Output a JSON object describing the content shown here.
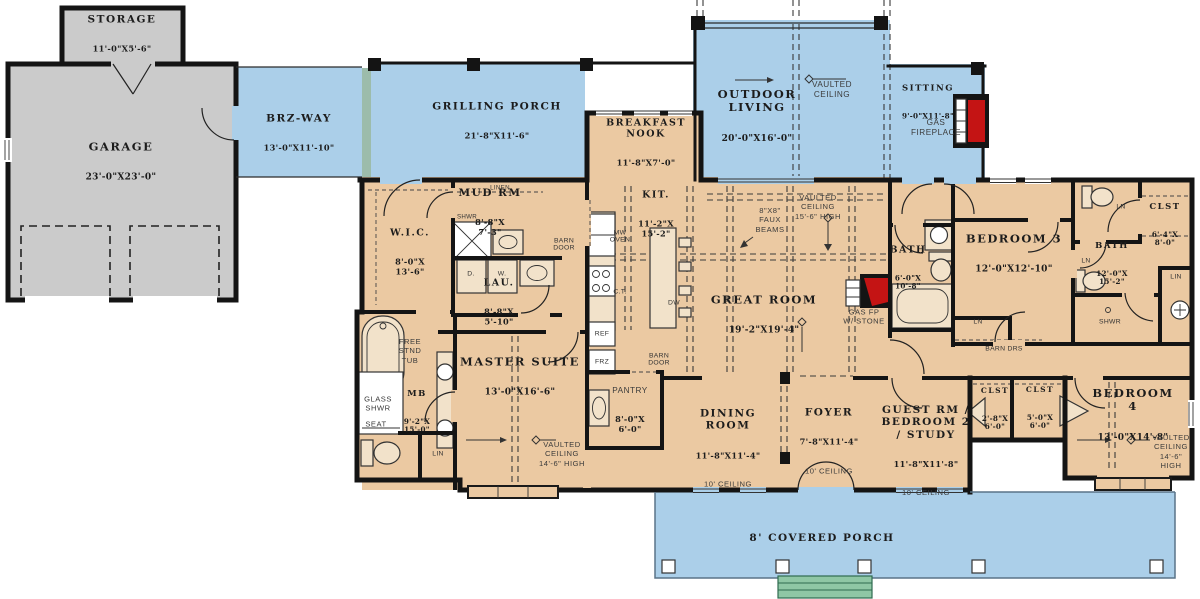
{
  "colors": {
    "porch": "#abcfe9",
    "interior": "#ebc9a2",
    "garage": "#cbcbcb",
    "wall": "#141414",
    "steps": "#8fc7a5",
    "fireplace": "#c41414",
    "accent": "#9cbcab"
  },
  "rooms": {
    "storage": {
      "name": "STORAGE",
      "dims": "11'-0\"X5'-6\""
    },
    "garage": {
      "name": "GARAGE",
      "dims": "23'-0\"X23'-0\""
    },
    "brz_way": {
      "name": "BRZ-WAY",
      "dims": "13'-0\"X11'-10\""
    },
    "grilling_porch": {
      "name": "GRILLING PORCH",
      "dims": "21'-8\"X11'-6\""
    },
    "breakfast_nook": {
      "name": "BREAKFAST\nNOOK",
      "dims": "11'-8\"X7'-0\""
    },
    "outdoor_living": {
      "name": "OUTDOOR\nLIVING",
      "dims": "20'-0\"X16'-0\""
    },
    "sitting": {
      "name": "SITTING",
      "dims": "9'-0\"X11'-8\""
    },
    "mud_rm": {
      "name": "MUD RM",
      "dims": "8'-8\"X\n7'-3\""
    },
    "wic": {
      "name": "W.I.C.",
      "dims": "8'-0\"X\n13'-6\""
    },
    "lau": {
      "name": "LAU.",
      "dims": "8'-8\"X\n5'-10\""
    },
    "kitchen": {
      "name": "KIT.",
      "dims": "11'-2\"X\n15'-2\""
    },
    "great_room": {
      "name": "GREAT ROOM",
      "dims": "19'-2\"X19'-4\""
    },
    "master_suite": {
      "name": "MASTER SUITE",
      "dims": "13'-0\"X16'-6\""
    },
    "master_bath": {
      "name": "MB",
      "dims": "9'-2\"X\n15'-0\""
    },
    "pantry": {
      "name": "PANTRY",
      "dims": "8'-0\"X\n6'-0\""
    },
    "dining": {
      "name": "DINING\nROOM",
      "dims": "11'-8\"X11'-4\"",
      "ceiling": "10' CEILING"
    },
    "foyer": {
      "name": "FOYER",
      "dims": "7'-8\"X11'-4\"",
      "ceiling": "10' CEILING"
    },
    "guest": {
      "name": "GUEST RM /\nBEDROOM 2\n/ STUDY",
      "dims": "11'-8\"X11'-8\"",
      "ceiling": "10' CEILING"
    },
    "bath_hall": {
      "name": "BATH",
      "dims": "6'-0\"X\n10'-8\""
    },
    "bedroom3": {
      "name": "BEDROOM 3",
      "dims": "12'-0\"X12'-10\""
    },
    "clst_hall": {
      "name": "CLST",
      "dims": "6'-4\"X\n8'-0\""
    },
    "bath_shared": {
      "name": "BATH",
      "dims": "12'-0\"X\n15'-2\""
    },
    "clst_guest_1": {
      "name": "CLST",
      "dims": "2'-8\"X\n6'-0\""
    },
    "clst_guest_2": {
      "name": "CLST",
      "dims": "5'-0\"X\n6'-0\""
    },
    "bedroom4": {
      "name": "BEDROOM 4",
      "dims": "13'-0\"X14'-8\""
    },
    "covered_porch": {
      "name": "8' COVERED PORCH"
    }
  },
  "notes": {
    "vaulted_outdoor": "VAULTED\nCEILING",
    "vaulted_great": "VAULTED\nCEILING\n15'-6\" HIGH",
    "vaulted_master": "VAULTED\nCEILING\n14'-6\" HIGH",
    "vaulted_bedroom4": "VAULTED\nCEILING\n14'-6\" HIGH",
    "faux_beams": "8\"X8\"\nFAUX\nBEAMS",
    "gas_fireplace": "GAS\nFIREPLACE",
    "gas_fp_stone": "GAS FP\nW/ STONE",
    "free_tub": "FREE\nSTND\nTUB",
    "glass_shwr": "GLASS\nSHWR",
    "seat": "SEAT"
  },
  "fixtures": {
    "linen": "LINEN",
    "shwr": "SHWR",
    "barn_door": "BARN\nDOOR",
    "barn_drs": "BARN DRS",
    "ln": "LN",
    "lin": "LIN",
    "dryer": "D.",
    "washer": "W.",
    "mw_oven": "MW\nOVEN",
    "cooktop": "C.T.",
    "dw": "DW",
    "ref": "REF",
    "frz": "FRZ"
  }
}
